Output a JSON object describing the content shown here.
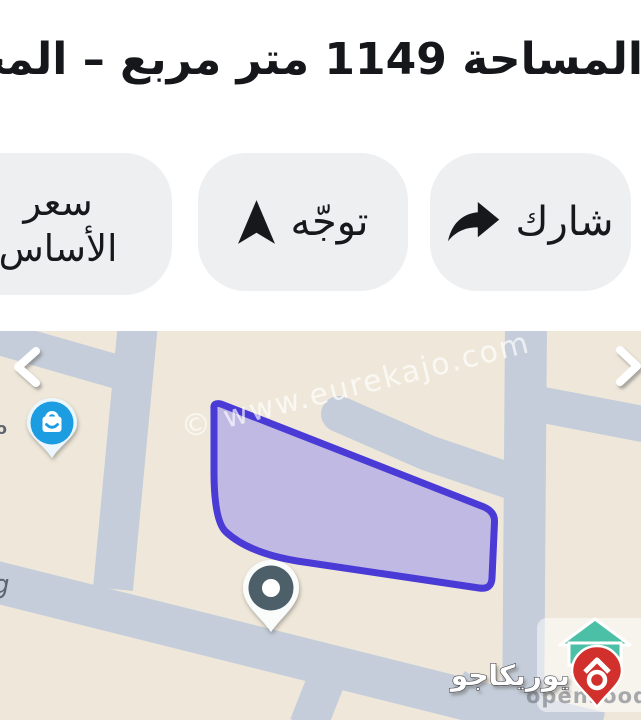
{
  "header": {
    "measurements": "المساحة 1149 متر مربع – المحيط 147 متر"
  },
  "buttons": {
    "share": "شارك",
    "directions": "توجّه",
    "base_price_line1": "سعر",
    "base_price_line2": "الأساس"
  },
  "map": {
    "watermark": "© www.eurekajo.com",
    "carousel_prev": "prev",
    "carousel_next": "next",
    "fragments": {
      "left_upper": "o",
      "left_lower": "g"
    },
    "brand": {
      "name_arabic": "يوريكاجو",
      "name_domain": "opensooq.com"
    }
  },
  "colors": {
    "plot_fill": "rgba(136,128,238,0.45)",
    "plot_stroke": "#4a3ad6",
    "road": "#c4cdd9",
    "map_bg": "#efe8da",
    "pin_blue": "#1b9ce1",
    "pin_dark": "#4d5f67",
    "logo_red": "#d2302c",
    "logo_green": "#4cc0a6",
    "button_bg": "#edeff1"
  }
}
